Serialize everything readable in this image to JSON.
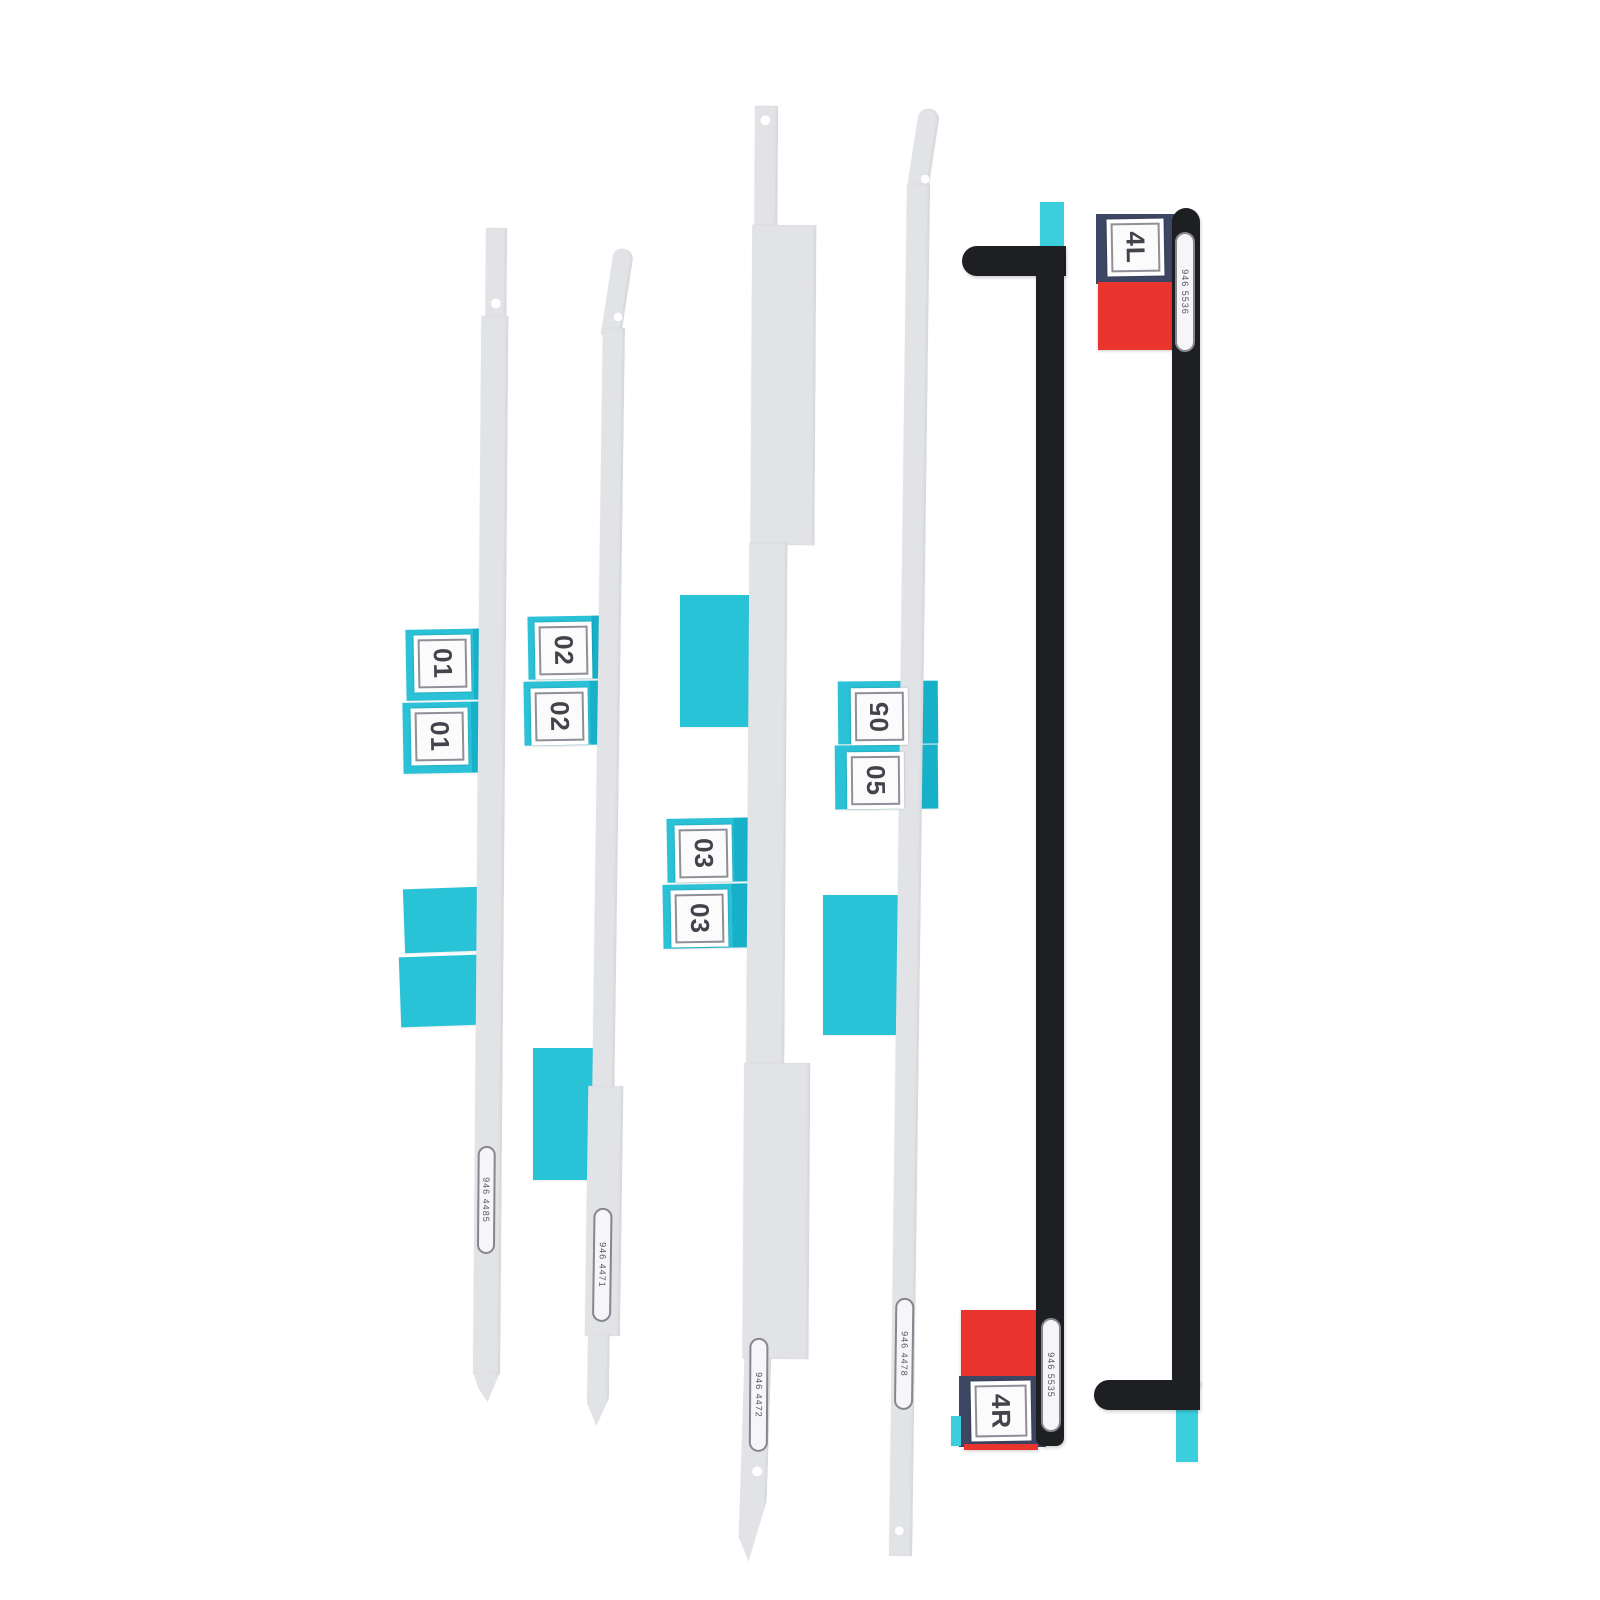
{
  "strips": [
    {
      "label": "01",
      "part_number": "946 4485"
    },
    {
      "label": "02",
      "part_number": "946 4471"
    },
    {
      "label": "03",
      "part_number": "946 4472"
    },
    {
      "label": "05",
      "part_number": "946 4478"
    },
    {
      "label": "4R",
      "part_number": "946 5535"
    },
    {
      "label": "4L",
      "part_number": "946 5536"
    }
  ],
  "colors": {
    "background": "#ffffff",
    "strip_white": "#e2e3e6",
    "tab_cyan": "#2bc2d7",
    "tab_cyan_dark": "#16b0c9",
    "tab_cyan_bright": "#3bcfdd",
    "tab_red": "#ea352f",
    "tab_navy": "#3d4663",
    "strip_black": "#1d1f23",
    "label_text": "#43434b"
  }
}
